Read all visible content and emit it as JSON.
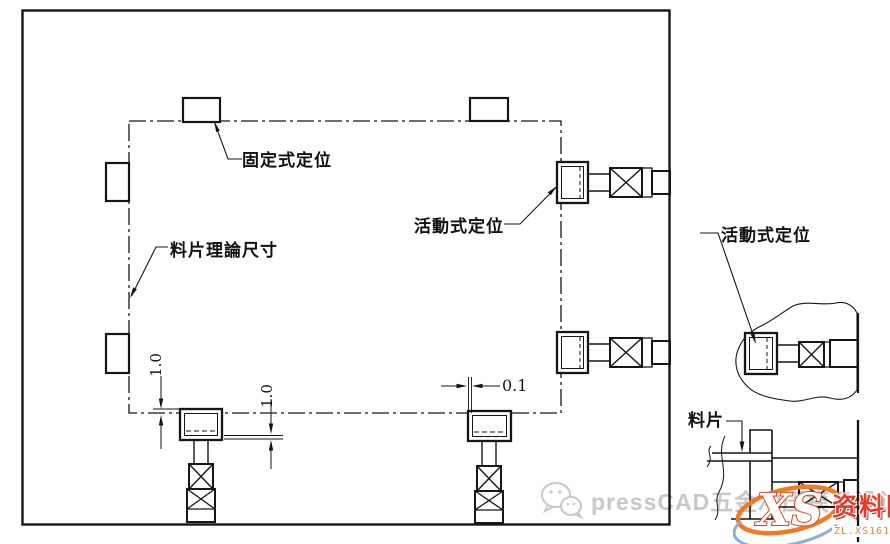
{
  "diagram": {
    "labels": {
      "fixed_stop": "固定式定位",
      "movable_stop": "活動式定位",
      "material_outline": "料片理論尺寸",
      "strip": "料片"
    },
    "dimensions": {
      "block_top_gap": "1.0",
      "block_bottom_gap": "1.0",
      "side_clearance": "0.1"
    },
    "colors": {
      "line": "#161616",
      "watermark_gray": "#c8c8c8",
      "logo_red": "#e63a2c",
      "logo_orange": "#f07d2a"
    }
  },
  "watermark": {
    "icon": "wechat-icon",
    "text": "pressCAD五金冲压模具设计"
  },
  "logo": {
    "monogram": "XS",
    "site_name": "资料网",
    "site_url": "ZL.XS1616.COM"
  }
}
